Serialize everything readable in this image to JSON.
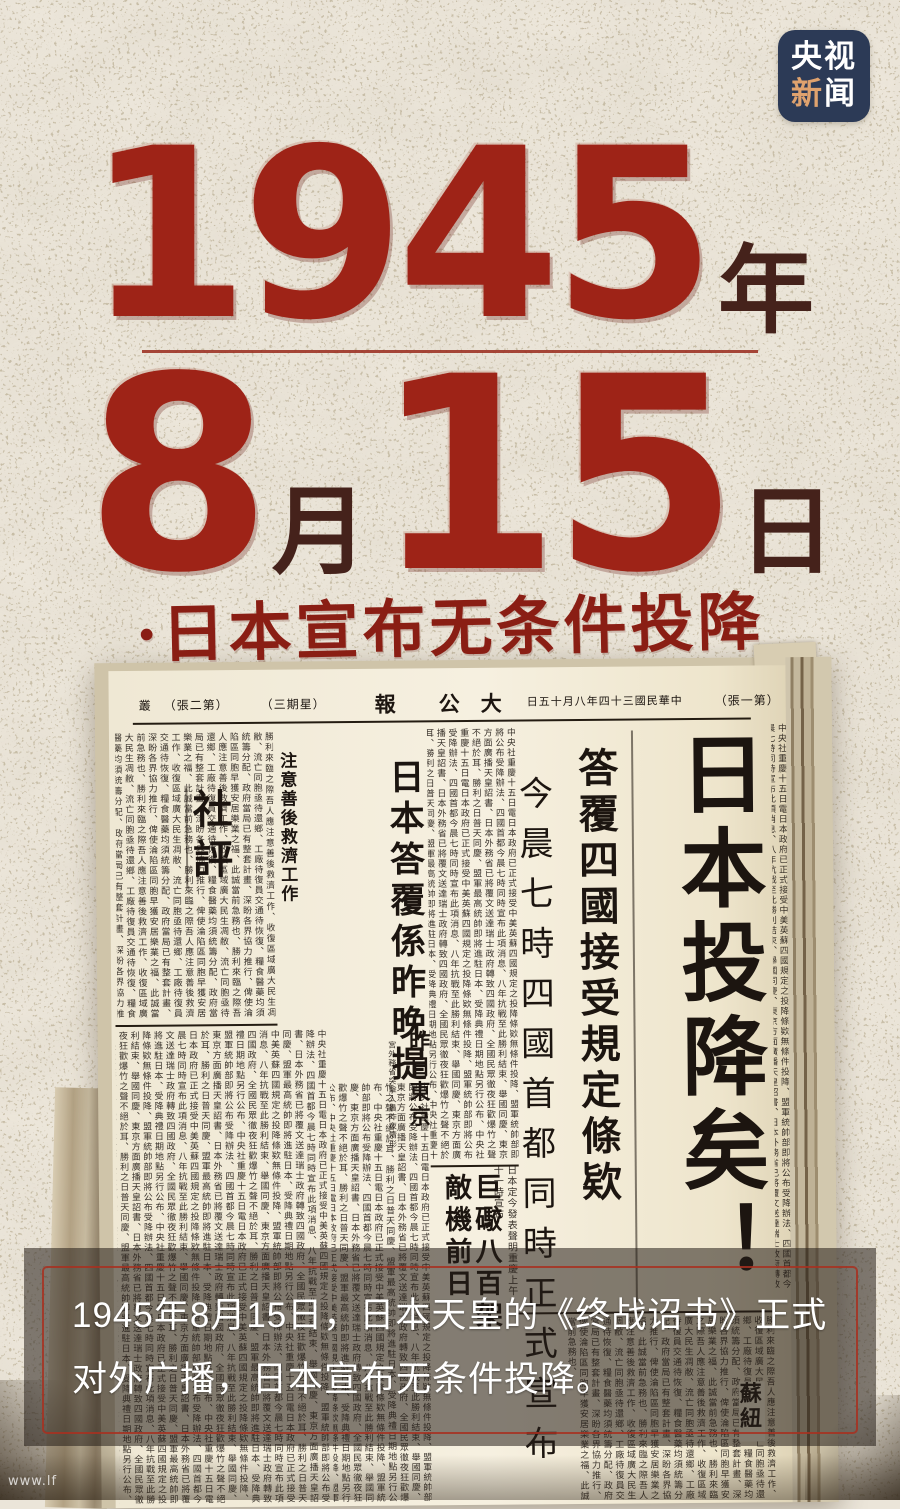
{
  "poster": {
    "logo": {
      "top": "央视",
      "bottom_accent": "新",
      "bottom_rest": "闻"
    },
    "date": {
      "year": "1945",
      "year_unit": "年",
      "month": "8",
      "month_unit": "月",
      "day": "15",
      "day_unit": "日"
    },
    "subtitle": "·日本宣布无条件投降",
    "caption": {
      "line1": "1945年8月15日，日本天皇的《终战诏书》正式",
      "line2": "对外广播，日本宣布无条件投降。"
    },
    "watermark": "www.lf"
  },
  "newspaper": {
    "masthead": {
      "edge": "叢",
      "sheet_note": "（張二第）",
      "weekday": "（三期星）",
      "title_char_1": "報",
      "title_char_2": "公",
      "title_char_3": "大",
      "date_line": "日五十月八年四十三國民華中",
      "page_note": "（張一第）"
    },
    "headline": "日本投降矣！",
    "deck": "答覆四國接受規定條欵",
    "time_line": "今晨七時四國首都同時正式宣布",
    "reply_head": "日本答覆係昨晚提出",
    "editorial_label": "社評",
    "editorial_head": "注意善後救濟工作",
    "tokyo_head": "昨日東京",
    "tokyo_sub": "宮外務省突擊人員昨夜情形",
    "bomb_head_right": "巨礮八百架",
    "bomb_head_left": "敵機前日",
    "brief_a": "日本定今發表聲明",
    "brief_b": "重慶上午十一時宣布",
    "soviet": "蘇紐",
    "filler_a": "中央社重慶十五日電日本政府已正式接受中美英蘇四國規定之投降條欵無條件投降、盟軍統帥部即將公布受降辦法、四國首都今晨七時同時宣布此項消息、八年抗戰至此勝利結束、舉國同慶、東京方面廣播天皇詔書、日本外務省已將覆文送達瑞士政府轉致四國政府、全國民眾徹夜狂歡爆竹之聲不絕於耳、勝利之日普天同慶、盟軍最高統帥即將進駐日本、受降典禮日期地點另行公布、",
    "filler_b": "勝利來臨之際吾人應注意善後救濟工作、收復區域廣大民生凋敝、流亡同胞亟待還鄉、工廠待復員交通待恢復、糧食醫藥均須統籌分配、政府當局已有整套計畫、深盼各界協力推行、俾使淪陷區同胞早獲安居樂業之福、此誠當前急務也、"
  },
  "colors": {
    "background": "#ebe5d9",
    "accent_red": "#9e2317",
    "dark_red": "#45221b",
    "calligraphy_red": "#8a1e14",
    "logo_navy": "#2c3a56",
    "logo_accent": "#dfa26e",
    "overlay_frame": "#a63422",
    "newsprint_ink": "#1c1510",
    "paper_cream": "#f3ecda"
  }
}
